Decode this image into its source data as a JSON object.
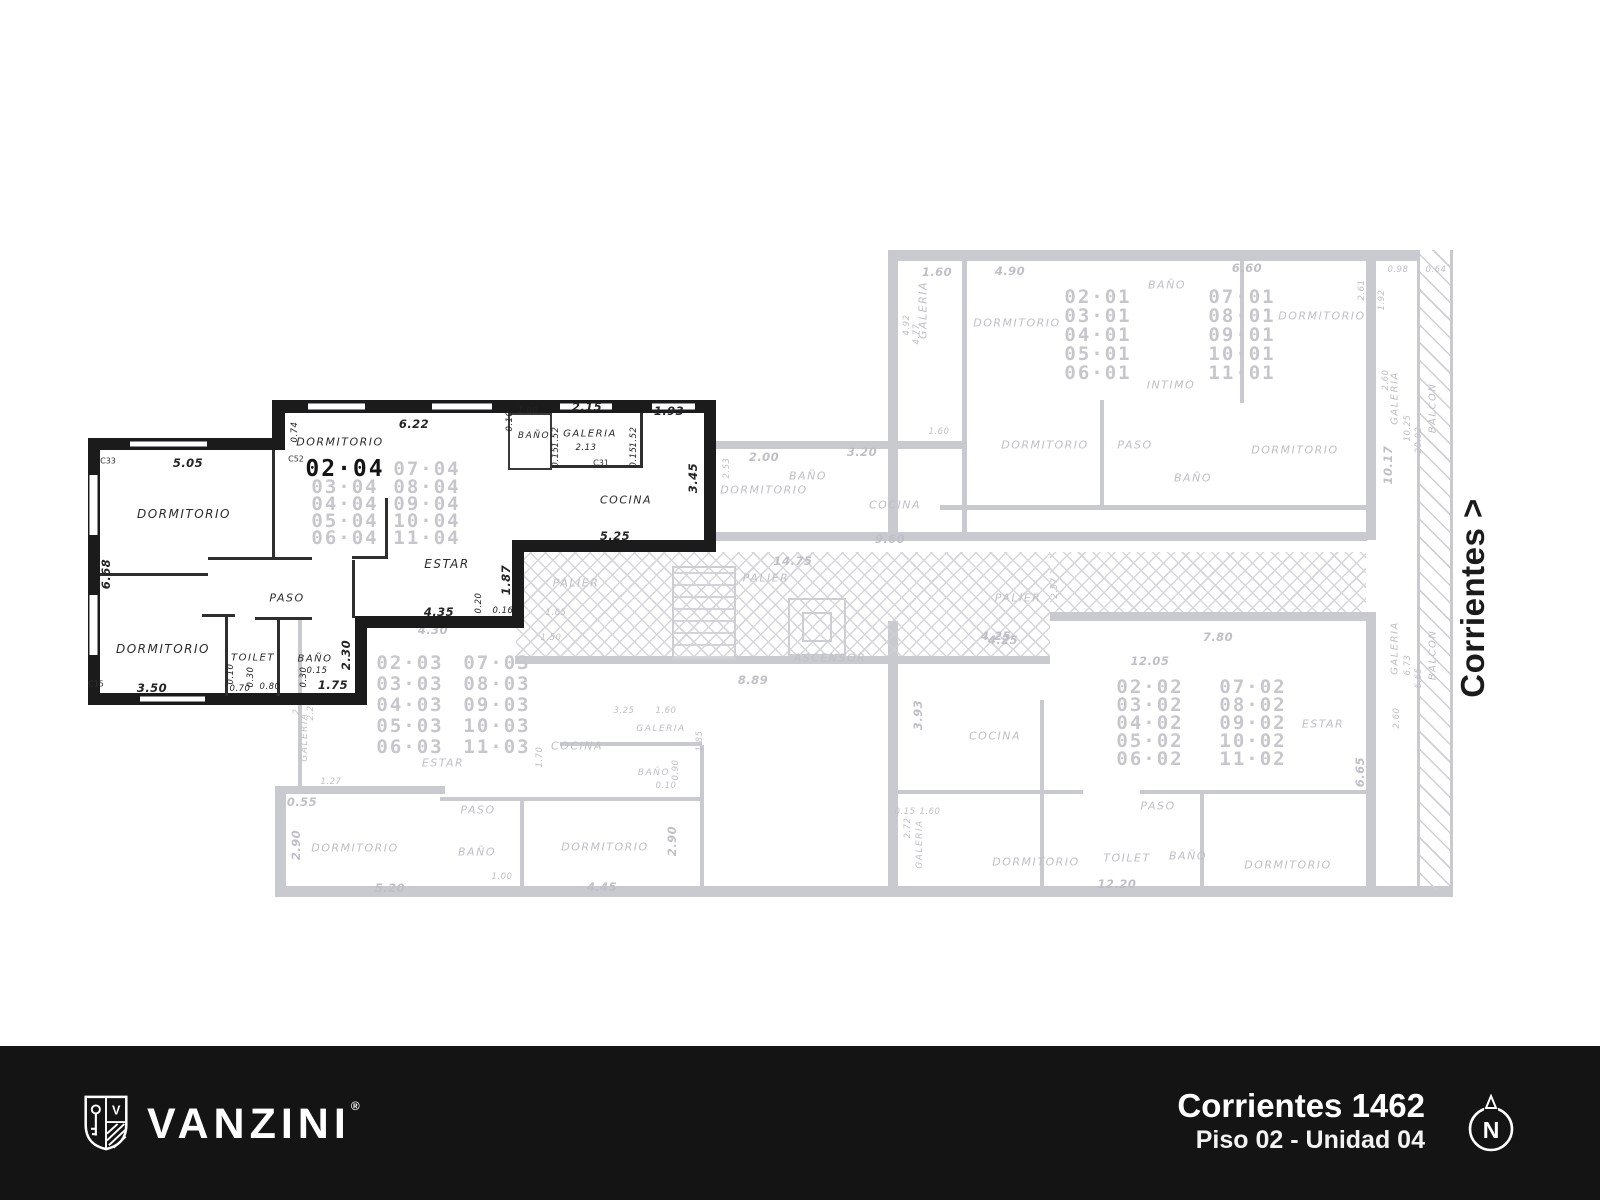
{
  "side_label": "Corrientes >",
  "footer": {
    "brand": "VANZINI",
    "reg": "®",
    "address": "Corrientes 1462",
    "unit": "Piso 02 - Unidad 04",
    "compass": "N",
    "bg_color": "#141414",
    "text_color": "#ffffff"
  },
  "u4": {
    "table": {
      "col1": [
        "02·04",
        "03·04",
        "04·04",
        "05·04",
        "06·04"
      ],
      "col2": [
        "07·04",
        "08·04",
        "09·04",
        "10·04",
        "11·04"
      ]
    },
    "rooms": {
      "dorm1": "DORMITORIO",
      "dorm2": "DORMITORIO",
      "dorm3": "DORMITORIO",
      "estar": "ESTAR",
      "paso": "PASO",
      "toilet": "TOILET",
      "bano": "BAÑO",
      "bano_top": "BAÑO",
      "galeria": "GALERIA",
      "cocina": "COCINA"
    },
    "dims": {
      "d505": "5.05",
      "d668": "6.68",
      "d350": "3.50",
      "d074": "0.74",
      "d622": "6.22",
      "d010": "0.10",
      "d100": "1.00",
      "d152a": "1.52",
      "d015a": "0.15",
      "d215": "2.15",
      "d152b": "1.52",
      "d015b": "0.15",
      "d193": "1.93",
      "d213": "2.13",
      "d345": "3.45",
      "d525": "5.25",
      "d187": "1.87",
      "d435": "4.35",
      "d020": "0.20",
      "d016": "0.16",
      "d230": "2.30",
      "d010b": "0.10",
      "d030a": "0.30",
      "d070": "0.70",
      "d080": "0.80",
      "d030b": "0.30",
      "d015c": "0.15",
      "d175": "1.75"
    },
    "marks": {
      "c33": "C33",
      "c52": "C52",
      "c31": "C31",
      "c15": "C15"
    }
  },
  "bg": {
    "u1": {
      "table": {
        "col1": [
          "02·01",
          "03·01",
          "04·01",
          "05·01",
          "06·01"
        ],
        "col2": [
          "07·01",
          "08·01",
          "09·01",
          "10·01",
          "11·01"
        ]
      },
      "rooms": {
        "galeria": "GALERIA",
        "dorm1": "DORMITORIO",
        "bano1": "BAÑO",
        "dorm2": "DORMITORIO",
        "intimo": "INTIMO",
        "dorm3": "DORMITORIO",
        "paso": "PASO",
        "bano2": "BAÑO",
        "dorm4": "DORMITORIO",
        "dorm5": "DORMITORIO",
        "bano3": "BAÑO",
        "cocina": "COCINA"
      },
      "dims": {
        "d160": "1.60",
        "d490": "4.90",
        "d660": "6.60",
        "d098": "0.98",
        "d064": "0.64",
        "d492": "4.92",
        "d477": "4.77",
        "d1017": "10.17",
        "d200": "2.00",
        "d320": "3.20",
        "d253": "2.53",
        "d960": "9.60",
        "d160b": "1.60",
        "d192": "1.92"
      }
    },
    "u2": {
      "table": {
        "col1": [
          "02·02",
          "03·02",
          "04·02",
          "05·02",
          "06·02"
        ],
        "col2": [
          "07·02",
          "08·02",
          "09·02",
          "10·02",
          "11·02"
        ]
      },
      "rooms": {
        "cocina": "COCINA",
        "estar": "ESTAR",
        "paso": "PASO",
        "toilet": "TOILET",
        "bano": "BAÑO",
        "dorm1": "DORMITORIO",
        "dorm2": "DORMITORIO",
        "galeria": "GALERIA"
      },
      "dims": {
        "d425": "4.25",
        "d780": "7.80",
        "d1205": "12.05",
        "d393": "3.93",
        "d665": "6.65",
        "d260": "2.60",
        "d1220": "12.20",
        "d272": "2.72",
        "d160": "1.60",
        "d015": "0.15"
      }
    },
    "u3": {
      "table": {
        "col1": [
          "02·03",
          "03·03",
          "04·03",
          "05·03",
          "06·03"
        ],
        "col2": [
          "07·03",
          "08·03",
          "09·03",
          "10·03",
          "11·03"
        ]
      },
      "rooms": {
        "estar": "ESTAR",
        "paso": "PASO",
        "bano1": "BAÑO",
        "dorm1": "DORMITORIO",
        "dorm2": "DORMITORIO",
        "cocina": "COCINA",
        "galeria1": "GALERIA",
        "galeria2": "GALERIA",
        "bano2": "BAÑO"
      },
      "dims": {
        "d430": "4.30",
        "d127": "1.27",
        "d055": "0.55",
        "d290a": "2.90",
        "d520": "5.20",
        "d100": "1.00",
        "d445": "4.45",
        "d290b": "2.90",
        "d165": "1.65",
        "d150": "1.50",
        "d170": "1.70",
        "d325": "3.25",
        "d160": "1.60",
        "d185": "1.85",
        "d090": "0.90",
        "d010": "0.10",
        "d226": "2.26",
        "d215": "2.15"
      }
    },
    "palier": {
      "label1": "PALIER",
      "label2": "PALIER",
      "label3": "PALIER",
      "ascensor": "ASCENSOR",
      "dims": {
        "d1475": "14.75",
        "d889": "8.89",
        "d425": "4.25",
        "d257": "2.57"
      }
    },
    "strip": {
      "galeria1": "GALERIA",
      "galeria2": "GALERIA",
      "balcon1": "BALCON",
      "balcon2": "BALCON",
      "dims": {
        "d1025": "10.25",
        "d2002": "20.02",
        "d260": "2.60",
        "d261": "2.61",
        "d673": "6.73",
        "d665": "6.65"
      }
    }
  }
}
